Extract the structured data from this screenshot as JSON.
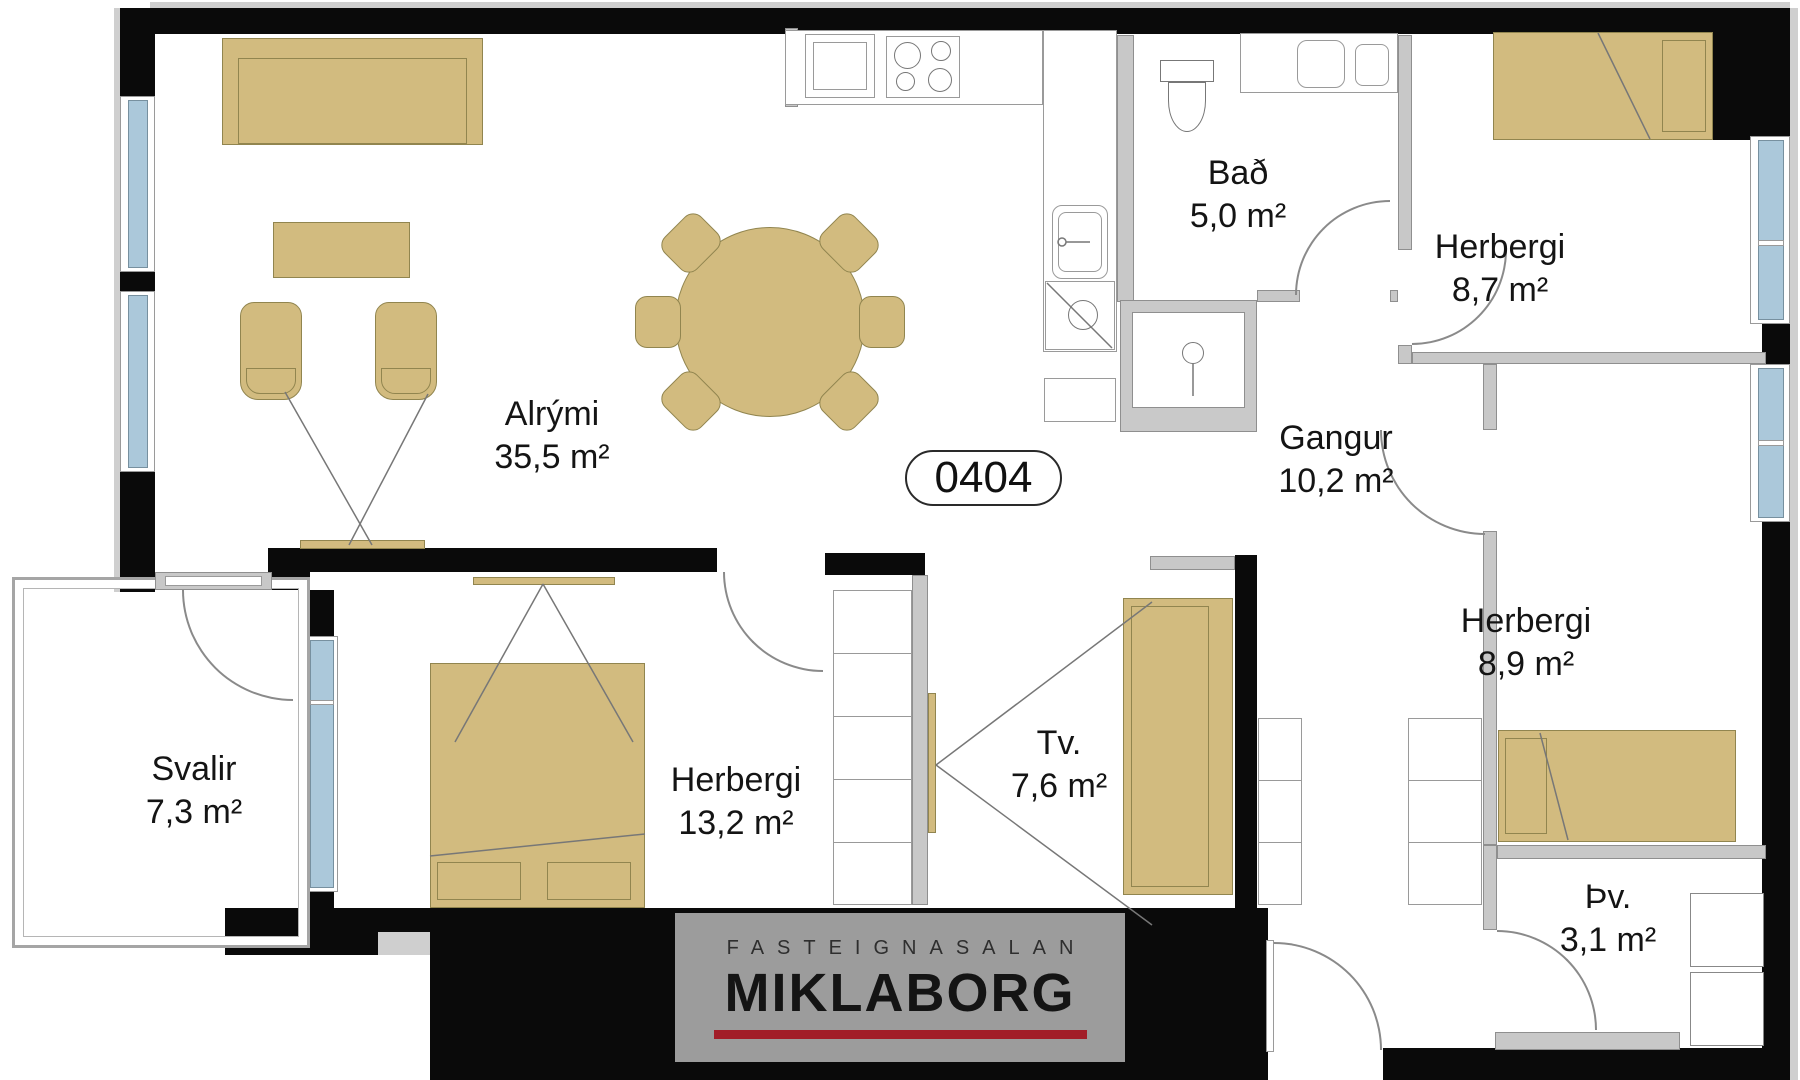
{
  "unit": {
    "badge": "0404"
  },
  "rooms": [
    {
      "id": "alrymi",
      "name": "Alrými",
      "area": "35,5 m²"
    },
    {
      "id": "bad",
      "name": "Bað",
      "area": "5,0 m²"
    },
    {
      "id": "herbergi-8-7",
      "name": "Herbergi",
      "area": "8,7 m²"
    },
    {
      "id": "gangur",
      "name": "Gangur",
      "area": "10,2 m²"
    },
    {
      "id": "herbergi-8-9",
      "name": "Herbergi",
      "area": "8,9 m²"
    },
    {
      "id": "herbergi-13-2",
      "name": "Herbergi",
      "area": "13,2 m²"
    },
    {
      "id": "tv",
      "name": "Tv.",
      "area": "7,6 m²"
    },
    {
      "id": "svalir",
      "name": "Svalir",
      "area": "7,3 m²"
    },
    {
      "id": "thvottahus",
      "name": "Þv.",
      "area": "3,1 m²"
    }
  ],
  "logo": {
    "subtitle": "FASTEIGNASALAN",
    "title": "MIKLABORG"
  },
  "colors": {
    "wall": "#0a0a0a",
    "partition_gray": "#c8c8c8",
    "furniture_tan": "#d2bb7f",
    "window_blue": "#abc8da",
    "logo_background": "#9c9c9c",
    "logo_red": "#a21d28"
  }
}
